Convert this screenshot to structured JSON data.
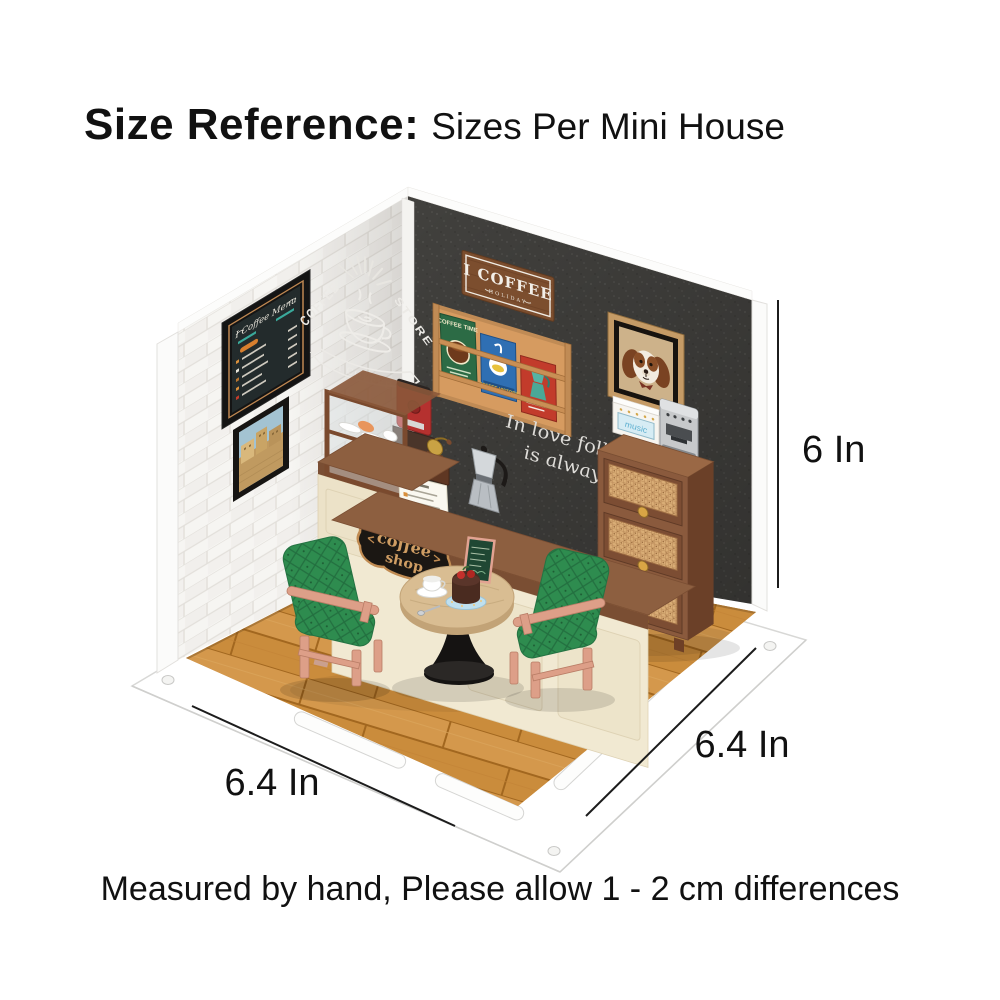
{
  "title": {
    "bold": "Size Reference",
    "separator": ":",
    "regular": "Sizes Per Mini House"
  },
  "dimensions": {
    "height_label": "6 In",
    "width_label": "6.4 In",
    "depth_label": "6.4 In"
  },
  "footer_note": "Measured by hand, Please allow 1 - 2 cm differences",
  "scene": {
    "hanging_sign": {
      "title": "I COFFEE",
      "subtitle": "HOLIDAY"
    },
    "chalk_mural": {
      "word_left": "COFFEE",
      "word_right": "STORE",
      "ribbon": "I COFFEE"
    },
    "wall_quote": {
      "line1": "In love folly",
      "line2": "is always s"
    },
    "menu_board_title": "I Coffee Menu",
    "magazines": [
      "COFFEE TIME",
      "COFFEE HISTORY"
    ],
    "radio_label": "music",
    "counter_sign": {
      "line1": "coffee",
      "line2": "shop"
    }
  },
  "colors": {
    "background": "#ffffff",
    "text": "#111111",
    "dimension_line": "#1c1c1c",
    "back_wall": "#41403d",
    "brick_wall": "#f6f5f2",
    "floor_wood": "#cf9143",
    "floor_seam": "#a2671f",
    "counter_cream": "#f1e9d2",
    "counter_top": "#8d5f40",
    "cabinet_brown": "#8a5a3d",
    "rattan": "#d9ad76",
    "chair_green": "#2e8c4f",
    "chair_wood": "#dd9f88",
    "table_wood": "#d9bd92",
    "sign_black": "#1b1713",
    "sign_gold": "#c08b52"
  }
}
